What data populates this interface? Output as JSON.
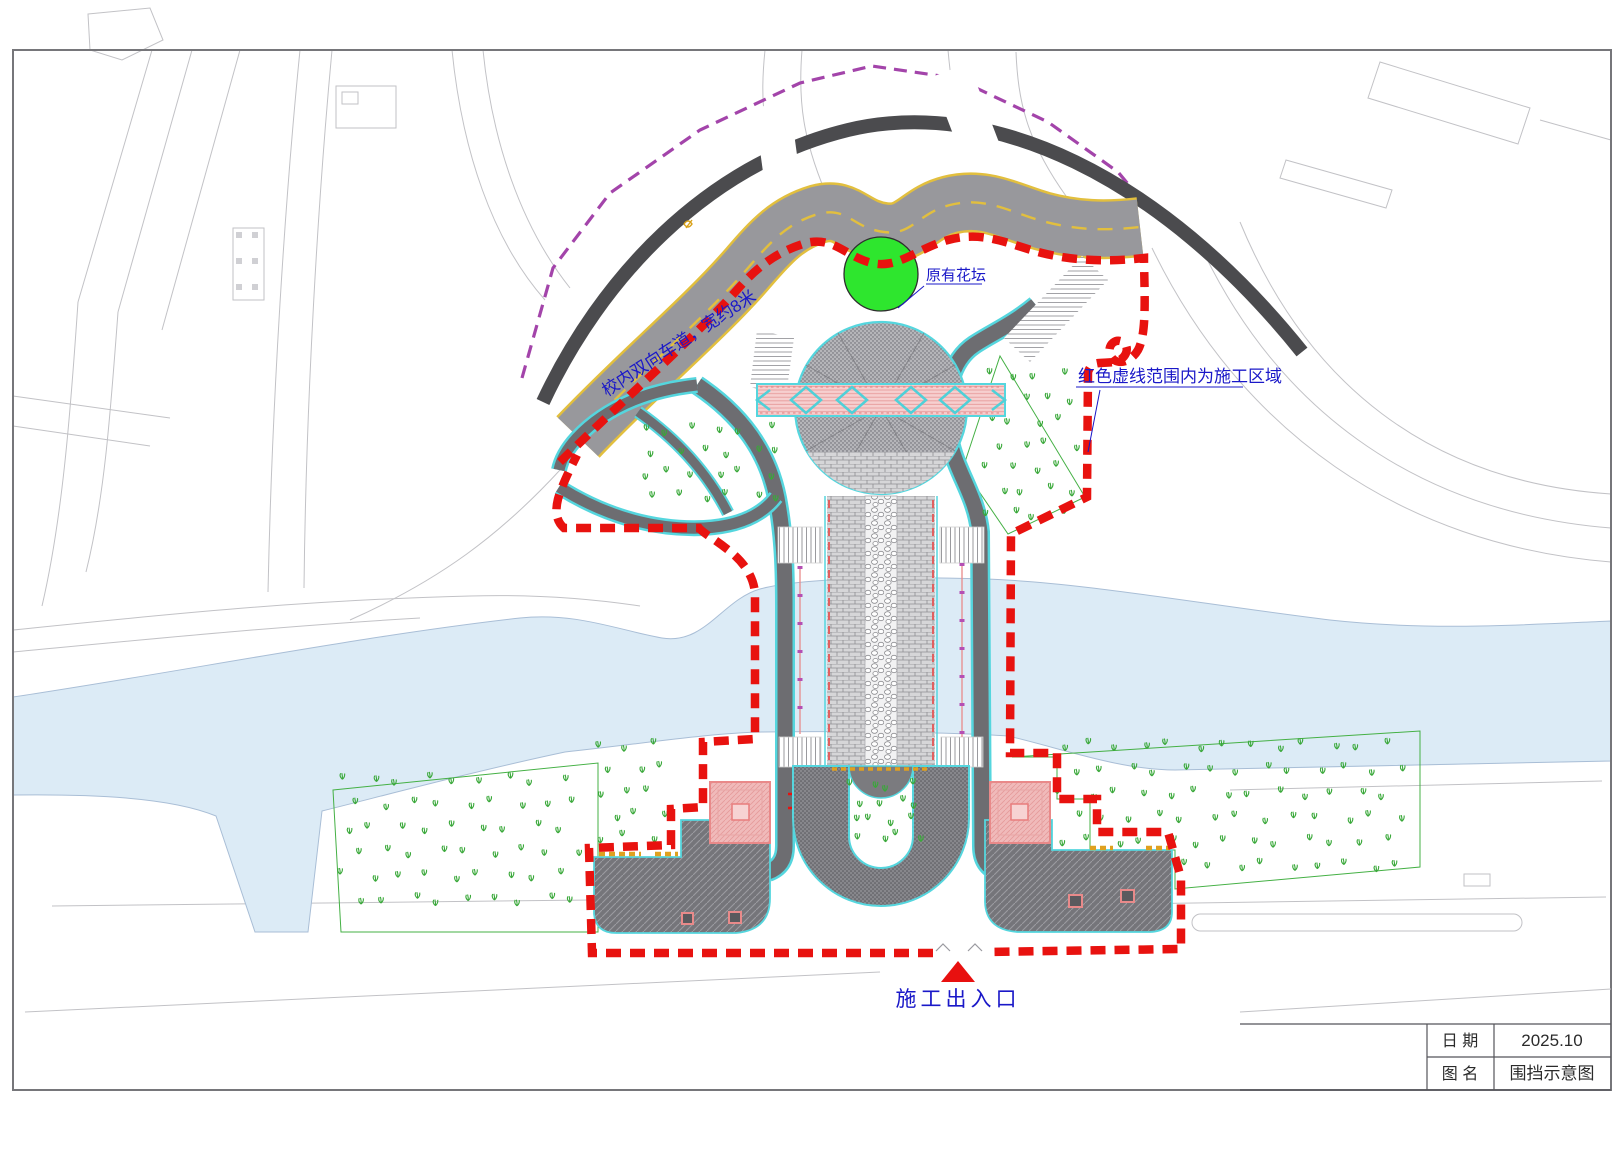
{
  "labels": {
    "road": "校内双向车道，宽约8米",
    "flowerbed": "原有花坛",
    "boundary_note": "红色虚线范围内为施工区域",
    "entrance": "施工出入口"
  },
  "title_block": {
    "date_label": "日  期",
    "date_value": "2025.10",
    "name_label": "图  名",
    "name_value": "围挡示意图"
  },
  "colors": {
    "construction_boundary": "#e8120f",
    "planned_boundary": "#a344aa",
    "road_surface": "#98989c",
    "road_edge_line": "#e2bf3e",
    "water": "#dcebf6",
    "flowerbed_green": "#2ee62e",
    "paving_edge_cyan": "#55d6de",
    "annotation_blue": "#1a18c8",
    "planting_symbol_green": "#39a839"
  }
}
